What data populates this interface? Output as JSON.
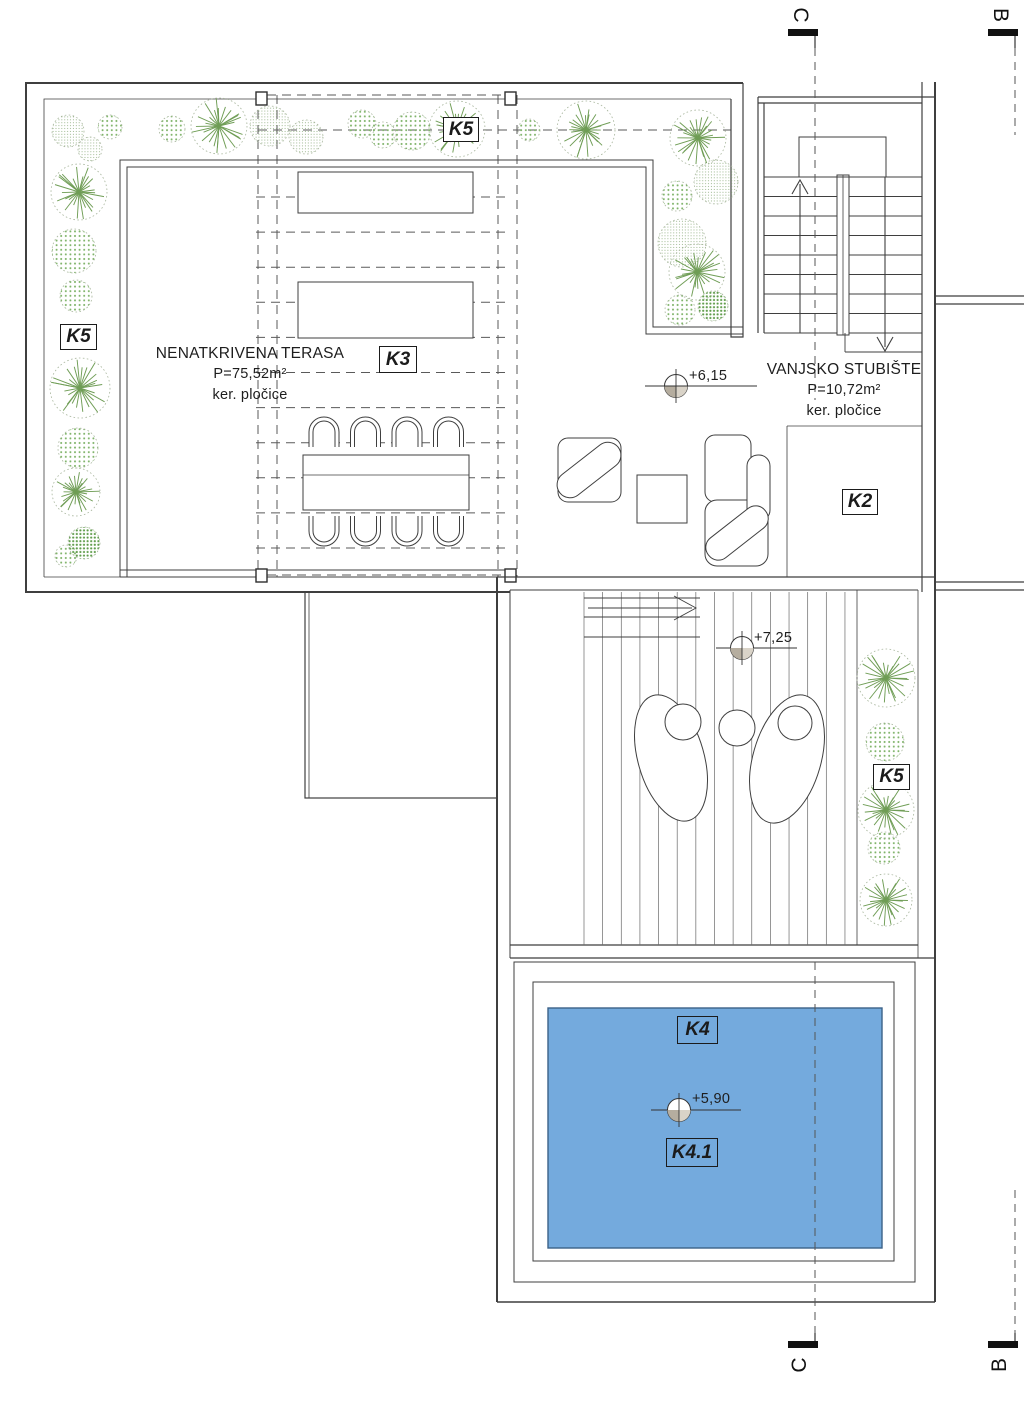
{
  "boxes": {
    "k5_top": "K5",
    "k5_left": "K5",
    "k5_right": "K5",
    "k3": "K3",
    "k2": "K2",
    "k4": "K4",
    "k4_1": "K4.1"
  },
  "rooms": {
    "terrace": {
      "name": "NENATKRIVENA TERASA",
      "area": "P=75,52m²",
      "finish": "ker. pločice"
    },
    "staircase": {
      "name": "VANJSKO STUBIŠTE",
      "area": "P=10,72m²",
      "finish": "ker. pločice"
    }
  },
  "elevations": {
    "corridor": "+6,15",
    "deck": "+7,25",
    "pool": "+5,90"
  },
  "sections": {
    "c": "C",
    "b": "B"
  },
  "colors": {
    "pool_fill": "#74aadd",
    "pool_stroke": "#3c6288",
    "line": "#3f3f3f",
    "thin": "#5a5a5a",
    "tree_line": "#6f9d55",
    "tree_outline": "#a7b59c",
    "bush_dot": "#7fb369",
    "bush_dot_fine": "#8cab7c",
    "bush_dot_dark": "#5f9c4a",
    "marker_dark": "#b5ad9f",
    "marker_light": "#d9d3c8",
    "section_marker": "#111111"
  }
}
